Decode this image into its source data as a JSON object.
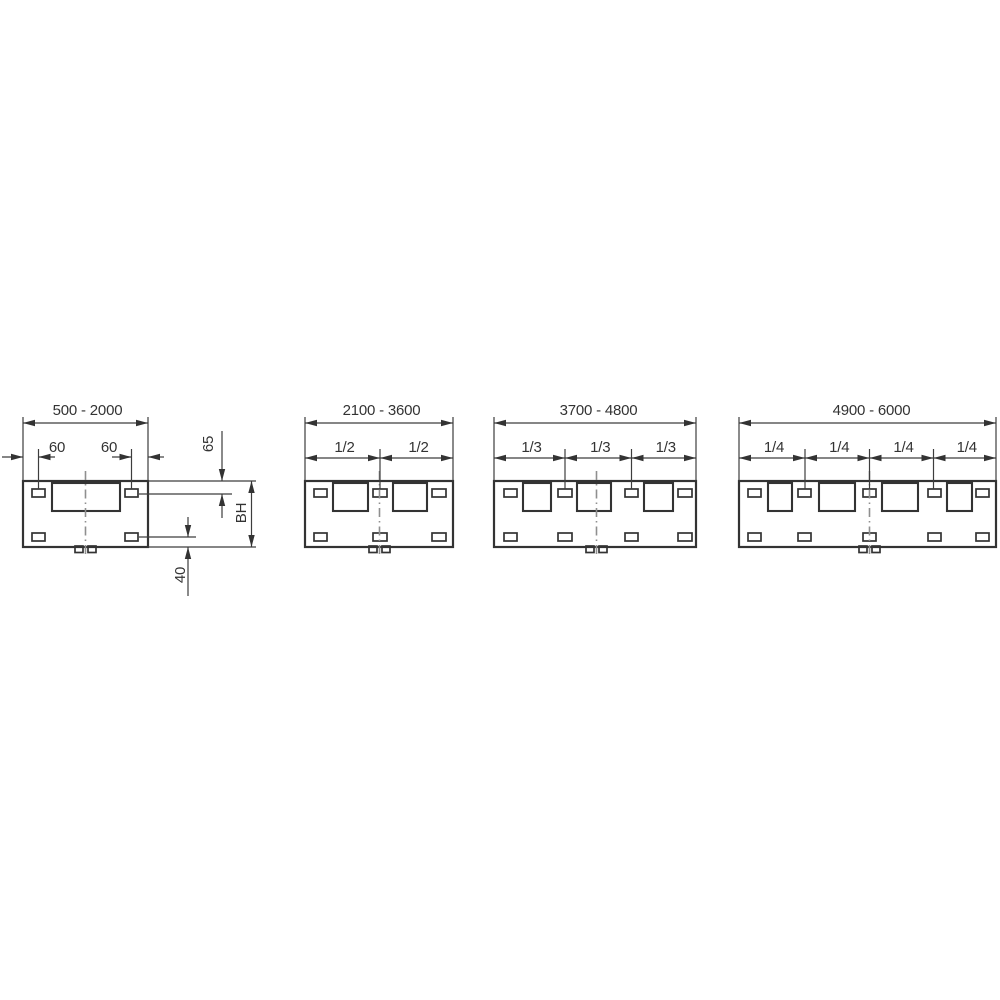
{
  "diagram": {
    "type": "technical-dimension-drawing",
    "colors": {
      "background": "#ffffff",
      "line": "#333333",
      "thin_line": "#3d3d3d",
      "centerline": "#8f8f8f",
      "text": "#333333"
    },
    "panels": [
      {
        "range": "500 - 2000",
        "offsets": {
          "left_slot": "60",
          "right_slot": "60",
          "top": "65",
          "body_height": "BH",
          "bottom": "40"
        }
      },
      {
        "range": "2100 - 3600",
        "fractions": [
          "1/2",
          "1/2"
        ]
      },
      {
        "range": "3700 - 4800",
        "fractions": [
          "1/3",
          "1/3",
          "1/3"
        ]
      },
      {
        "range": "4900 - 6000",
        "fractions": [
          "1/4",
          "1/4",
          "1/4",
          "1/4"
        ]
      }
    ]
  }
}
